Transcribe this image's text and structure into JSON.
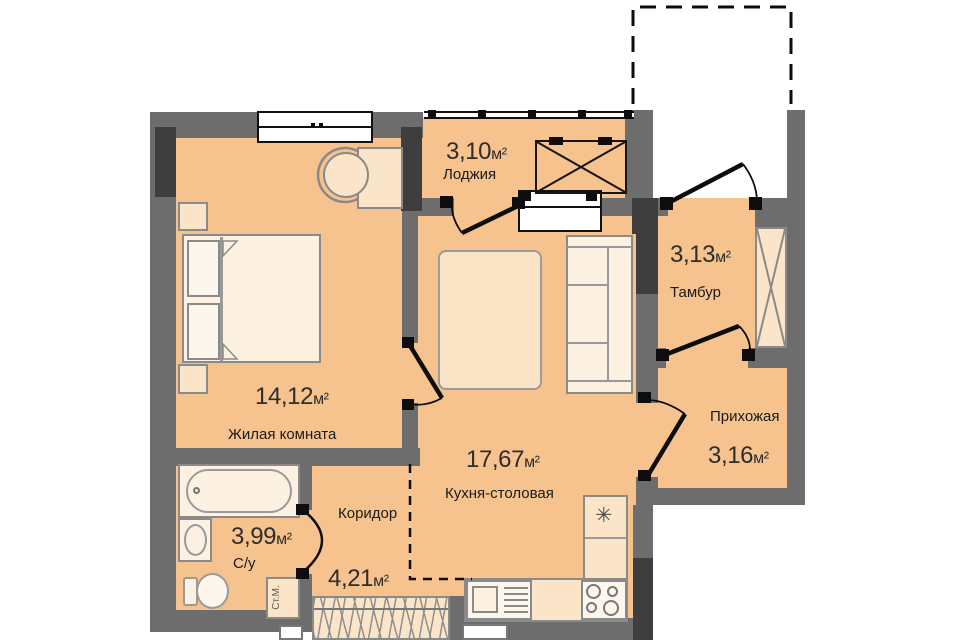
{
  "rooms": {
    "loggia": {
      "name": "Лоджия",
      "area": "3,10",
      "unit": "м²"
    },
    "living": {
      "name": "Жилая комната",
      "area": "14,12",
      "unit": "м²"
    },
    "kitchen": {
      "name": "Кухня-столовая",
      "area": "17,67",
      "unit": "м²"
    },
    "tambour": {
      "name": "Тамбур",
      "area": "3,13",
      "unit": "м²"
    },
    "hallway": {
      "name": "Прихожая",
      "area": "3,16",
      "unit": "м²"
    },
    "bathroom": {
      "name": "С/у",
      "area": "3,99",
      "unit": "м²"
    },
    "corridor": {
      "name": "Коридор",
      "area": "4,21",
      "unit": "м²"
    }
  },
  "appliances": {
    "washing_machine_label": "Ст.М.",
    "fridge_symbol": "✳"
  },
  "colors": {
    "floor": "#f6c28e",
    "wall": "#6d6d6d",
    "wall_pier": "#3e3e3e",
    "furniture": "#fbe5c8",
    "furniture_light": "#fdf2e2",
    "line": "#111111"
  }
}
